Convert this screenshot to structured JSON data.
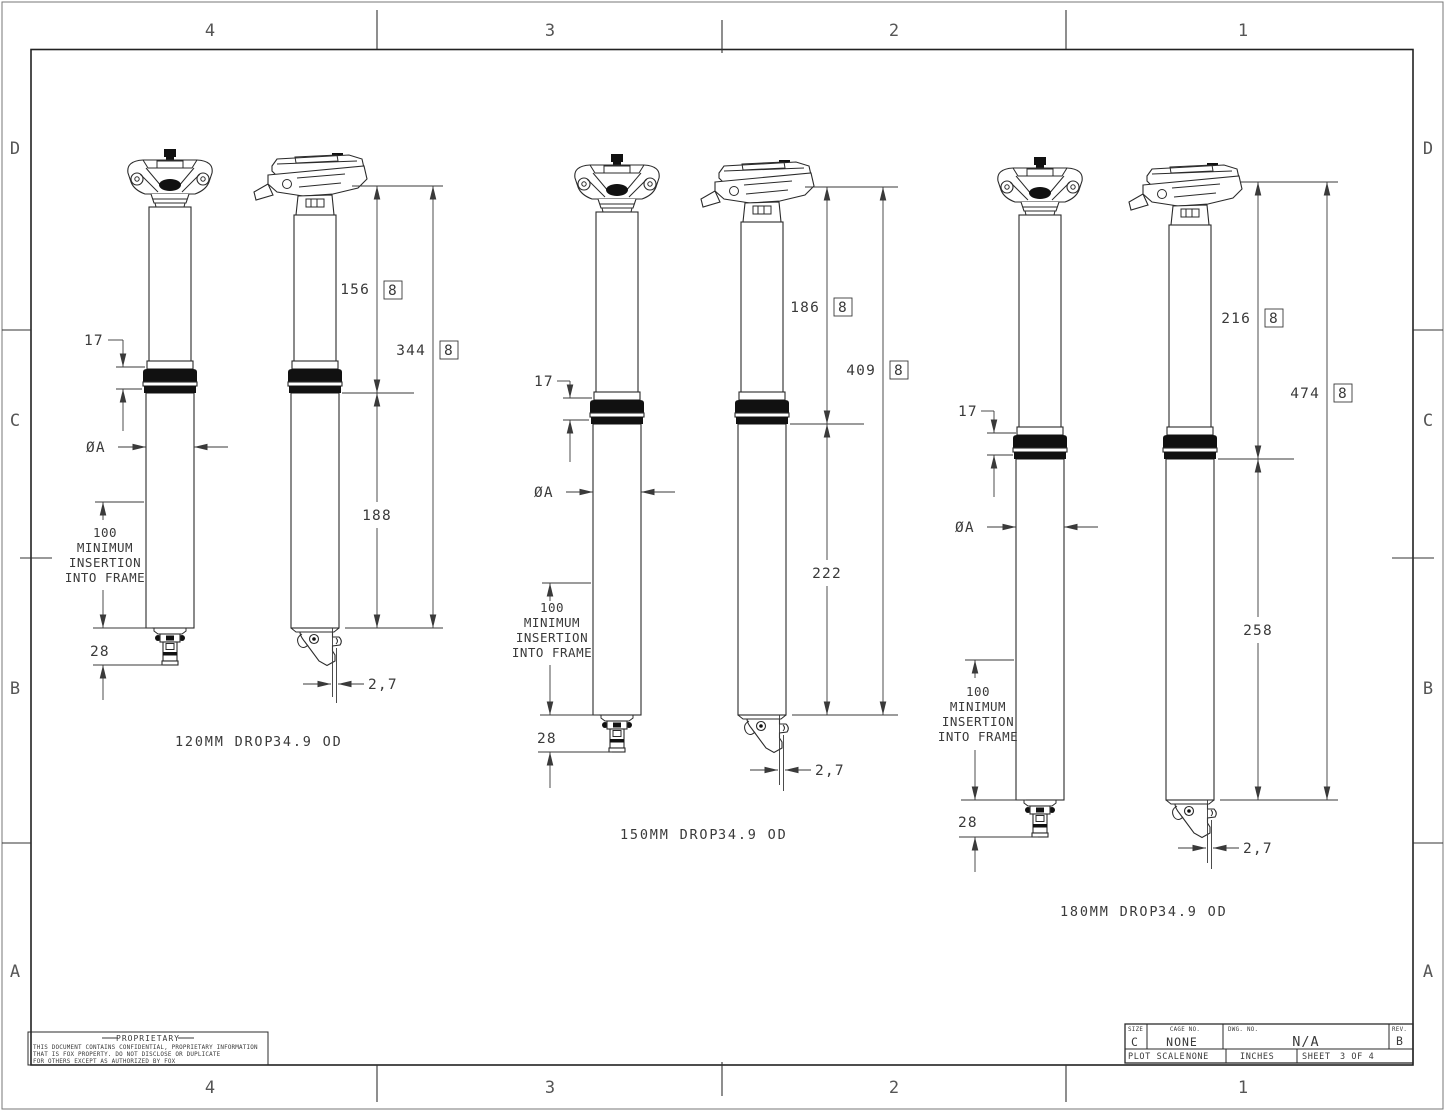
{
  "sheet": {
    "zones_top": [
      "4",
      "3",
      "2",
      "1"
    ],
    "zones_bottom": [
      "4",
      "3",
      "2",
      "1"
    ],
    "zones_left": [
      "D",
      "C",
      "B",
      "A"
    ],
    "zones_right": [
      "D",
      "C",
      "B",
      "A"
    ]
  },
  "groups": [
    {
      "caption_drop": "120MM DROP",
      "caption_od": "34.9 OD",
      "dim_collar": "17",
      "dim_upper": "156",
      "dim_upper_flag": "8",
      "dim_total": "344",
      "dim_total_flag": "8",
      "dim_diameter": "ØA",
      "dim_lower": "188",
      "insertion": [
        "100",
        "MINIMUM",
        "INSERTION",
        "INTO FRAME"
      ],
      "dim_actuator": "28",
      "dim_offset": "2,7"
    },
    {
      "caption_drop": "150MM DROP",
      "caption_od": "34.9 OD",
      "dim_collar": "17",
      "dim_upper": "186",
      "dim_upper_flag": "8",
      "dim_total": "409",
      "dim_total_flag": "8",
      "dim_diameter": "ØA",
      "dim_lower": "222",
      "insertion": [
        "100",
        "MINIMUM",
        "INSERTION",
        "INTO FRAME"
      ],
      "dim_actuator": "28",
      "dim_offset": "2,7"
    },
    {
      "caption_drop": "180MM DROP",
      "caption_od": "34.9 OD",
      "dim_collar": "17",
      "dim_upper": "216",
      "dim_upper_flag": "8",
      "dim_total": "474",
      "dim_total_flag": "8",
      "dim_diameter": "ØA",
      "dim_lower": "258",
      "insertion": [
        "100",
        "MINIMUM",
        "INSERTION",
        "INTO FRAME"
      ],
      "dim_actuator": "28",
      "dim_offset": "2,7"
    }
  ],
  "proprietary": {
    "heading": "PROPRIETARY",
    "line1": "THIS DOCUMENT CONTAINS CONFIDENTIAL, PROPRIETARY INFORMATION",
    "line2": "THAT IS FOX PROPERTY.  DO NOT DISCLOSE OR DUPLICATE",
    "line3": "FOR OTHERS EXCEPT AS AUTHORIZED BY FOX"
  },
  "title_block": {
    "size_label": "SIZE",
    "size_value": "C",
    "cage_label": "CAGE NO.",
    "cage_value": "NONE",
    "dwg_label": "DWG. NO.",
    "dwg_value": "N/A",
    "rev_label": "REV.",
    "rev_value": "B",
    "plot_scale_label": "PLOT SCALE",
    "plot_scale_value": "NONE",
    "units_value": "INCHES",
    "sheet_label": "SHEET",
    "sheet_value": "3 OF 4"
  }
}
